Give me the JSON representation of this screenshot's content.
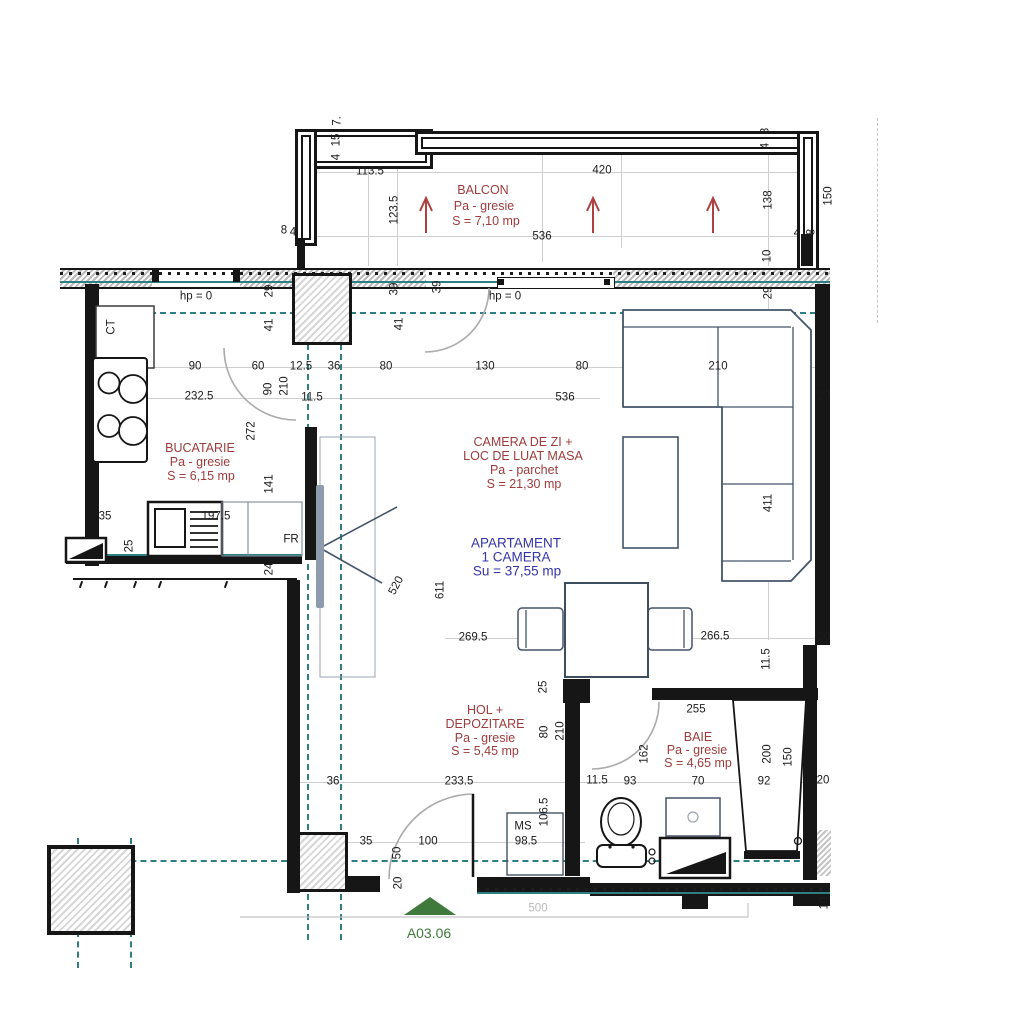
{
  "drawing": {
    "code": "A03.06",
    "apartment": {
      "name": "APARTAMENT",
      "type": "1 CAMERA",
      "usable_area": "Su = 37,55 mp"
    },
    "rooms": [
      {
        "name": "BALCON",
        "finish": "Pa - gresie",
        "area": "S = 7,10 mp"
      },
      {
        "name": "BUCATARIE",
        "finish": "Pa - gresie",
        "area": "S = 6,15 mp"
      },
      {
        "name": "CAMERA DE ZI + LOC DE LUAT MASA",
        "finish": "Pa - parchet",
        "area": "S = 21,30 mp"
      },
      {
        "name": "HOL + DEPOZITARE",
        "finish": "Pa - gresie",
        "area": "S = 5,45 mp"
      },
      {
        "name": "BAIE",
        "finish": "Pa - gresie",
        "area": "S = 4,65 mp"
      }
    ],
    "markers": [
      "CT",
      "FR",
      "MS",
      "hp = 0"
    ]
  },
  "colors": {
    "wall": "#161616",
    "furniture_outline": "#44546a",
    "axis_teal": "#2e7f83",
    "room_text_red": "#9e3b3b",
    "apartment_text_blue": "#3434aa",
    "code_green": "#3f7a3c",
    "arrow_red": "#b04040"
  },
  "annotations": [
    {
      "t": "BALCON",
      "x": 483,
      "y": 190,
      "c": "room"
    },
    {
      "t": "Pa - gresie",
      "x": 484,
      "y": 206,
      "c": "room"
    },
    {
      "t": "S = 7,10 mp",
      "x": 486,
      "y": 221,
      "c": "room"
    },
    {
      "t": "BUCATARIE",
      "x": 200,
      "y": 448,
      "c": "room"
    },
    {
      "t": "Pa - gresie",
      "x": 200,
      "y": 462,
      "c": "room"
    },
    {
      "t": "S = 6,15 mp",
      "x": 201,
      "y": 476,
      "c": "room"
    },
    {
      "t": "CAMERA DE ZI +",
      "x": 523,
      "y": 442,
      "c": "room"
    },
    {
      "t": "LOC DE LUAT MASA",
      "x": 523,
      "y": 456,
      "c": "room"
    },
    {
      "t": "Pa - parchet",
      "x": 524,
      "y": 470,
      "c": "room"
    },
    {
      "t": "S = 21,30 mp",
      "x": 524,
      "y": 484,
      "c": "room"
    },
    {
      "t": "HOL +",
      "x": 485,
      "y": 710,
      "c": "room"
    },
    {
      "t": "DEPOZITARE",
      "x": 485,
      "y": 724,
      "c": "room"
    },
    {
      "t": "Pa - gresie",
      "x": 485,
      "y": 738,
      "c": "room"
    },
    {
      "t": "S = 5,45 mp",
      "x": 485,
      "y": 751,
      "c": "room"
    },
    {
      "t": "BAIE",
      "x": 698,
      "y": 737,
      "c": "room"
    },
    {
      "t": "Pa - gresie",
      "x": 697,
      "y": 750,
      "c": "room"
    },
    {
      "t": "S = 4,65 mp",
      "x": 698,
      "y": 763,
      "c": "room"
    },
    {
      "t": "APARTAMENT",
      "x": 516,
      "y": 543,
      "c": "apt"
    },
    {
      "t": "1 CAMERA",
      "x": 516,
      "y": 557,
      "c": "apt"
    },
    {
      "t": "Su = 37,55 mp",
      "x": 517,
      "y": 571,
      "c": "apt"
    },
    {
      "t": "A03.06",
      "x": 429,
      "y": 933,
      "c": "code"
    },
    {
      "t": "113.5",
      "x": 370,
      "y": 172
    },
    {
      "t": "420",
      "x": 602,
      "y": 171
    },
    {
      "t": "536",
      "x": 542,
      "y": 237
    },
    {
      "t": "123.5",
      "x": 395,
      "y": 210,
      "r": -90
    },
    {
      "t": "138",
      "x": 769,
      "y": 200,
      "r": -90
    },
    {
      "t": "150",
      "x": 829,
      "y": 196,
      "r": -90
    },
    {
      "t": "7.",
      "x": 338,
      "y": 121,
      "r": -90
    },
    {
      "t": "15",
      "x": 337,
      "y": 140,
      "r": -90
    },
    {
      "t": "4",
      "x": 337,
      "y": 157,
      "r": -90
    },
    {
      "t": "8",
      "x": 284,
      "y": 231
    },
    {
      "t": "4",
      "x": 293,
      "y": 233
    },
    {
      "t": "8",
      "x": 766,
      "y": 131,
      "r": -90
    },
    {
      "t": "4",
      "x": 766,
      "y": 146,
      "r": -90
    },
    {
      "t": "4",
      "x": 797,
      "y": 234
    },
    {
      "t": "8",
      "x": 812,
      "y": 232,
      "r": -90
    },
    {
      "t": "10",
      "x": 768,
      "y": 256,
      "r": -90
    },
    {
      "t": "29",
      "x": 769,
      "y": 293,
      "r": -90
    },
    {
      "t": "hp = 0",
      "x": 196,
      "y": 297
    },
    {
      "t": "hp = 0",
      "x": 505,
      "y": 297
    },
    {
      "t": "39",
      "x": 395,
      "y": 289,
      "r": -90
    },
    {
      "t": "39",
      "x": 438,
      "y": 287,
      "r": -90
    },
    {
      "t": "29",
      "x": 270,
      "y": 291,
      "r": -90
    },
    {
      "t": "41",
      "x": 270,
      "y": 325,
      "r": -90
    },
    {
      "t": "41",
      "x": 400,
      "y": 324,
      "r": -90
    },
    {
      "t": "90",
      "x": 195,
      "y": 367
    },
    {
      "t": "60",
      "x": 258,
      "y": 367
    },
    {
      "t": "12.5",
      "x": 301,
      "y": 367
    },
    {
      "t": "36",
      "x": 334,
      "y": 367
    },
    {
      "t": "80",
      "x": 386,
      "y": 367
    },
    {
      "t": "130",
      "x": 485,
      "y": 367
    },
    {
      "t": "80",
      "x": 582,
      "y": 367
    },
    {
      "t": "210",
      "x": 718,
      "y": 367
    },
    {
      "t": "232.5",
      "x": 199,
      "y": 397
    },
    {
      "t": "536",
      "x": 565,
      "y": 398
    },
    {
      "t": "90",
      "x": 269,
      "y": 389,
      "r": -90
    },
    {
      "t": "210",
      "x": 285,
      "y": 386,
      "r": -90
    },
    {
      "t": "11.5",
      "x": 312,
      "y": 398
    },
    {
      "t": "272",
      "x": 252,
      "y": 431,
      "r": -90
    },
    {
      "t": "141",
      "x": 270,
      "y": 484,
      "r": -90
    },
    {
      "t": "197.5",
      "x": 216,
      "y": 517
    },
    {
      "t": "35",
      "x": 105,
      "y": 517
    },
    {
      "t": "25",
      "x": 130,
      "y": 546,
      "r": -90
    },
    {
      "t": "24",
      "x": 270,
      "y": 569,
      "r": -90
    },
    {
      "t": "FR",
      "x": 291,
      "y": 540
    },
    {
      "t": "CT",
      "x": 112,
      "y": 327,
      "r": -90
    },
    {
      "t": "520",
      "x": 397,
      "y": 586,
      "r": -62
    },
    {
      "t": "611",
      "x": 441,
      "y": 590,
      "r": -90
    },
    {
      "t": "20",
      "x": 824,
      "y": 397
    },
    {
      "t": "411",
      "x": 769,
      "y": 503,
      "r": -90
    },
    {
      "t": "269.5",
      "x": 473,
      "y": 638
    },
    {
      "t": "266.5",
      "x": 715,
      "y": 637
    },
    {
      "t": "20",
      "x": 824,
      "y": 638
    },
    {
      "t": "11.5",
      "x": 767,
      "y": 659,
      "r": -90
    },
    {
      "t": "25",
      "x": 544,
      "y": 687,
      "r": -90
    },
    {
      "t": "255",
      "x": 696,
      "y": 710
    },
    {
      "t": "80",
      "x": 545,
      "y": 732,
      "r": -90
    },
    {
      "t": "210",
      "x": 561,
      "y": 731,
      "r": -90
    },
    {
      "t": "162",
      "x": 645,
      "y": 754,
      "r": -90
    },
    {
      "t": "200",
      "x": 768,
      "y": 754,
      "r": -90
    },
    {
      "t": "150",
      "x": 789,
      "y": 757,
      "r": -90
    },
    {
      "t": "36",
      "x": 333,
      "y": 782
    },
    {
      "t": "233.5",
      "x": 459,
      "y": 782
    },
    {
      "t": "11.5",
      "x": 597,
      "y": 781
    },
    {
      "t": "93",
      "x": 630,
      "y": 782
    },
    {
      "t": "70",
      "x": 698,
      "y": 782
    },
    {
      "t": "92",
      "x": 764,
      "y": 782
    },
    {
      "t": "20",
      "x": 823,
      "y": 781
    },
    {
      "t": "35",
      "x": 366,
      "y": 842
    },
    {
      "t": "100",
      "x": 428,
      "y": 842
    },
    {
      "t": "50",
      "x": 398,
      "y": 853,
      "r": -90
    },
    {
      "t": "20",
      "x": 399,
      "y": 883,
      "r": -90
    },
    {
      "t": "106.5",
      "x": 545,
      "y": 812,
      "r": -90
    },
    {
      "t": "MS",
      "x": 523,
      "y": 827
    },
    {
      "t": "98.5",
      "x": 526,
      "y": 842
    },
    {
      "t": "10",
      "x": 825,
      "y": 903,
      "r": -90
    },
    {
      "t": "500",
      "x": 538,
      "y": 909,
      "c": "faint"
    }
  ]
}
